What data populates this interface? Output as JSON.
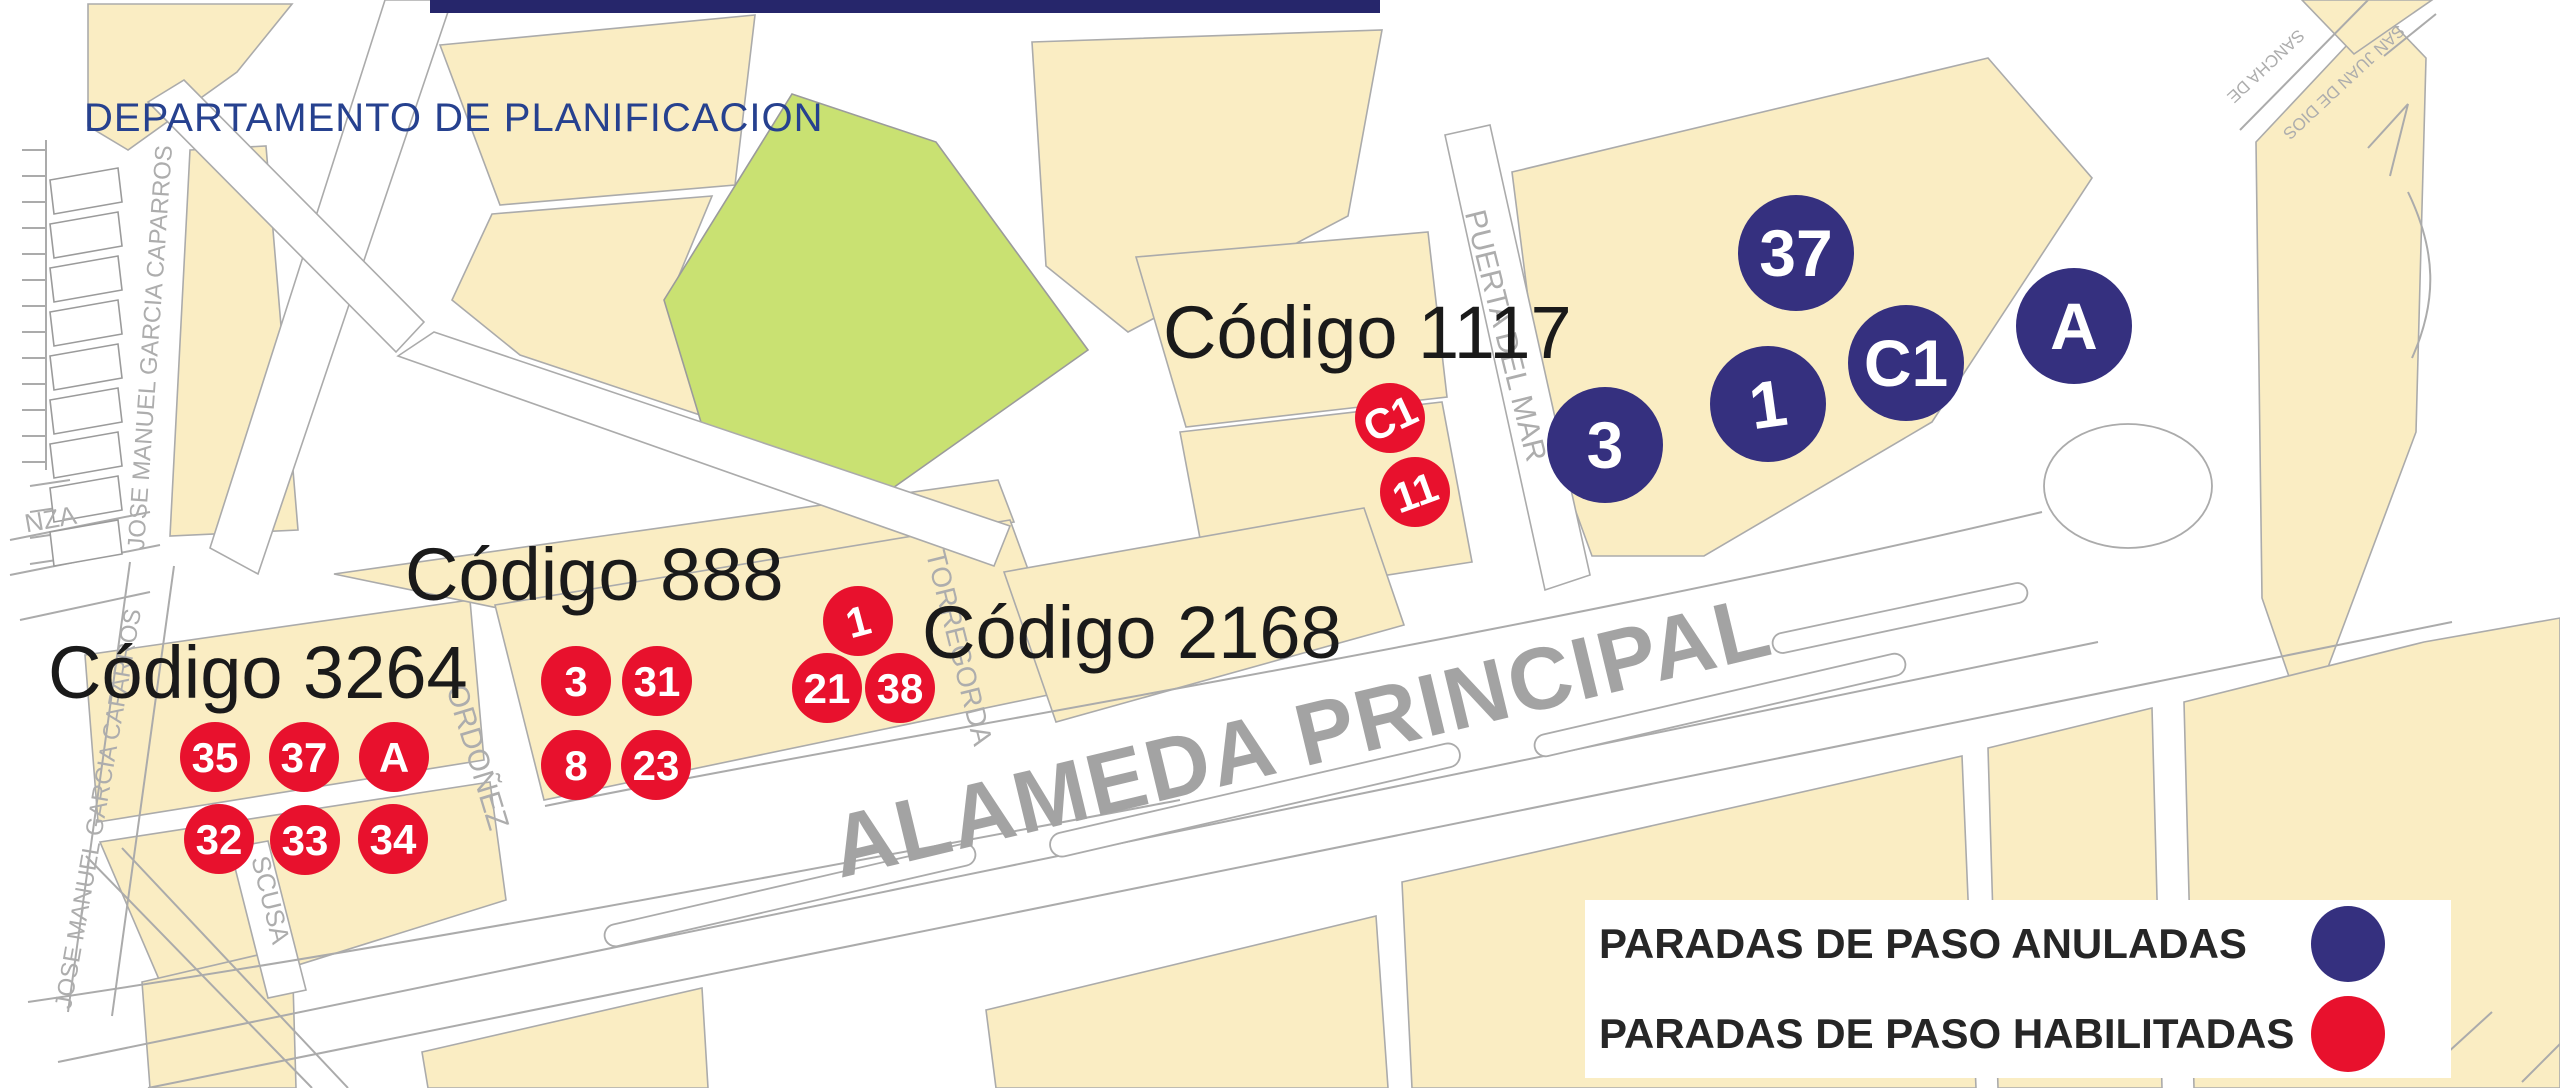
{
  "header": {
    "title": "DEPARTAMENTO DE PLANIFICACION"
  },
  "legend": {
    "items": [
      {
        "label": "PARADAS DE PASO ANULADAS",
        "color": "#35307F",
        "meaning": "cancelled pass-through stops"
      },
      {
        "label": "PARADAS DE PASO HABILITADAS",
        "color": "#E8112D",
        "meaning": "enabled pass-through stops"
      }
    ]
  },
  "map": {
    "avenue_label": {
      "t": "ALAMEDA PRINCIPAL",
      "x": 840,
      "y": 878,
      "rot": -13.5,
      "s": 88
    },
    "street_labels": [
      {
        "t": "JOSE MANUEL GARCIA CAPARROS",
        "x": 158,
        "y": 348,
        "rot": -86,
        "s": 24
      },
      {
        "t": "JOSE MANUEL GARCIA CAPARROS",
        "x": 106,
        "y": 810,
        "rot": -80,
        "s": 24
      },
      {
        "t": "ORDOÑEZ",
        "x": 468,
        "y": 760,
        "rot": 73,
        "s": 30
      },
      {
        "t": "TORREGORDA",
        "x": 950,
        "y": 650,
        "rot": 76,
        "s": 28
      },
      {
        "t": "PUERTA DEL MAR",
        "x": 1496,
        "y": 338,
        "rot": 76,
        "s": 30
      },
      {
        "t": "SCUSA",
        "x": 262,
        "y": 902,
        "rot": 76,
        "s": 26
      },
      {
        "t": "NZA",
        "x": 52,
        "y": 528,
        "rot": -10,
        "s": 26
      },
      {
        "t": "SANCHA DE",
        "x": 2262,
        "y": 62,
        "rot": 137,
        "s": 17
      },
      {
        "t": "SAN JUAN DE DIOS",
        "x": 2340,
        "y": 78,
        "rot": 137,
        "s": 17
      }
    ],
    "stop_groups": [
      {
        "id": "3264",
        "label": "Código 3264",
        "label_x": 48,
        "label_y": 698,
        "stops": [
          {
            "t": "35",
            "x": 215,
            "y": 757
          },
          {
            "t": "37",
            "x": 304,
            "y": 757
          },
          {
            "t": "A",
            "x": 394,
            "y": 757
          },
          {
            "t": "32",
            "x": 219,
            "y": 839
          },
          {
            "t": "33",
            "x": 305,
            "y": 840
          },
          {
            "t": "34",
            "x": 393,
            "y": 839
          }
        ]
      },
      {
        "id": "888",
        "label": "Código 888",
        "label_x": 405,
        "label_y": 600,
        "stops": [
          {
            "t": "3",
            "x": 576,
            "y": 681
          },
          {
            "t": "31",
            "x": 657,
            "y": 681
          },
          {
            "t": "8",
            "x": 576,
            "y": 765
          },
          {
            "t": "23",
            "x": 656,
            "y": 765
          }
        ]
      },
      {
        "id": "2168",
        "label": "Código 2168",
        "label_x": 922,
        "label_y": 658,
        "stops": [
          {
            "t": "1",
            "x": 858,
            "y": 621,
            "rot": -15
          },
          {
            "t": "21",
            "x": 827,
            "y": 688
          },
          {
            "t": "38",
            "x": 900,
            "y": 688
          }
        ]
      },
      {
        "id": "1117",
        "label": "Código 1117",
        "label_x": 1163,
        "label_y": 358,
        "stops": [
          {
            "t": "C1",
            "x": 1390,
            "y": 418,
            "rot": -25
          },
          {
            "t": "11",
            "x": 1415,
            "y": 492,
            "rot": -20
          }
        ]
      }
    ],
    "cancelled_stops": [
      {
        "t": "3",
        "x": 1605,
        "y": 445
      },
      {
        "t": "1",
        "x": 1768,
        "y": 404,
        "rot": -8
      },
      {
        "t": "C1",
        "x": 1906,
        "y": 363
      },
      {
        "t": "A",
        "x": 2074,
        "y": 326
      },
      {
        "t": "37",
        "x": 1796,
        "y": 253
      }
    ]
  },
  "colors": {
    "block_cream": "#FAEDC3",
    "park_green": "#C9E172",
    "stop_enabled_red": "#E8112D",
    "stop_cancelled_navy": "#35307F",
    "street_line_gray": "#ABABAB",
    "map_label_gray": "#ADADAD",
    "avenue_text_gray": "#A3A3A3",
    "title_blue": "#26418F",
    "top_bar_navy": "#26266B",
    "code_text_black": "#1A1A1A",
    "legend_text": "#262626"
  }
}
